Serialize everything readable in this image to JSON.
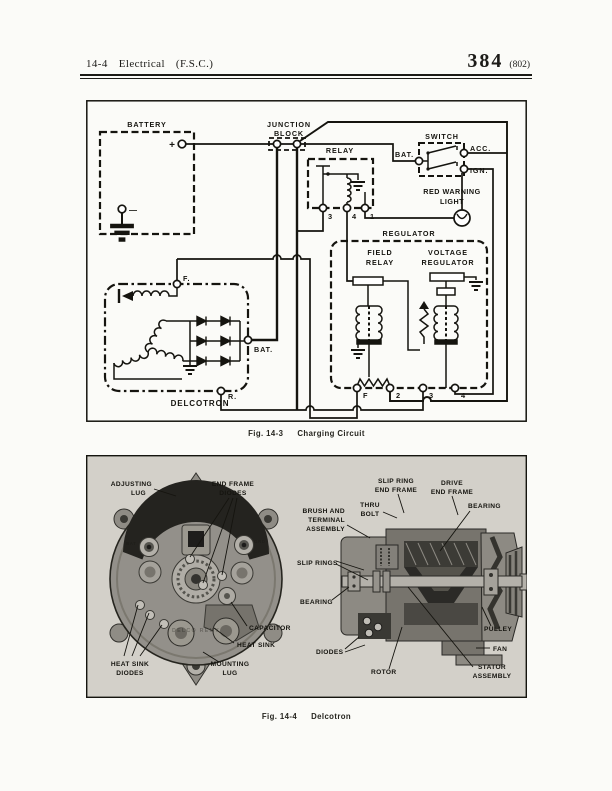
{
  "header": {
    "section": "14-4",
    "title": "Electrical",
    "subtitle": "(F.S.C.)",
    "page_number": "384",
    "edition": "(802)"
  },
  "fig1": {
    "caption_no": "Fig. 14-3",
    "caption_title": "Charging Circuit",
    "battery": {
      "label": "BATTERY",
      "plus": "+",
      "minus": "—"
    },
    "junction_block": {
      "line1": "JUNCTION",
      "line2": "BLOCK"
    },
    "relay": {
      "label": "RELAY",
      "t3": "3",
      "t4": "4",
      "t1": "1"
    },
    "switch": {
      "label": "SWITCH",
      "bat": "BAT.",
      "acc": "ACC.",
      "ign": "IGN."
    },
    "warning_light": {
      "line1": "RED WARNING",
      "line2": "LIGHT"
    },
    "regulator": {
      "label": "REGULATOR",
      "field_relay_line1": "FIELD",
      "field_relay_line2": "RELAY",
      "voltage_line1": "VOLTAGE",
      "voltage_line2": "REGULATOR",
      "tf": "F",
      "t2": "2",
      "t3": "3",
      "t4": "4"
    },
    "delcotron": {
      "label": "DELCOTRON",
      "f": "F.",
      "bat": "BAT.",
      "r": "R."
    }
  },
  "fig2": {
    "caption_no": "Fig. 14-4",
    "caption_title": "Delcotron",
    "left": {
      "adjusting_lug1": "ADJUSTING",
      "adjusting_lug2": "LUG",
      "end_frame_diodes1": "END FRAME",
      "end_frame_diodes2": "DIODES",
      "capacitor": "CAPACITOR",
      "heat_sink": "HEAT SINK",
      "heat_sink_diodes1": "HEAT SINK",
      "heat_sink_diodes2": "DIODES",
      "mounting_lug1": "MOUNTING",
      "mounting_lug2": "LUG",
      "embossed": "DELCO REMY",
      "stamp_bat": "BAT",
      "stamp_grd": "GRD"
    },
    "right": {
      "slip_ring_end_frame1": "SLIP RING",
      "slip_ring_end_frame2": "END FRAME",
      "drive_end_frame1": "DRIVE",
      "drive_end_frame2": "END FRAME",
      "thru_bolt1": "THRU",
      "thru_bolt2": "BOLT",
      "brush1": "BRUSH AND",
      "brush2": "TERMINAL",
      "brush3": "ASSEMBLY",
      "bearing_top": "BEARING",
      "slip_rings": "SLIP RINGS",
      "bearing_left": "BEARING",
      "diodes": "DIODES",
      "rotor": "ROTOR",
      "pulley": "PULLEY",
      "fan": "FAN",
      "stator1": "STATOR",
      "stator2": "ASSEMBLY"
    }
  }
}
